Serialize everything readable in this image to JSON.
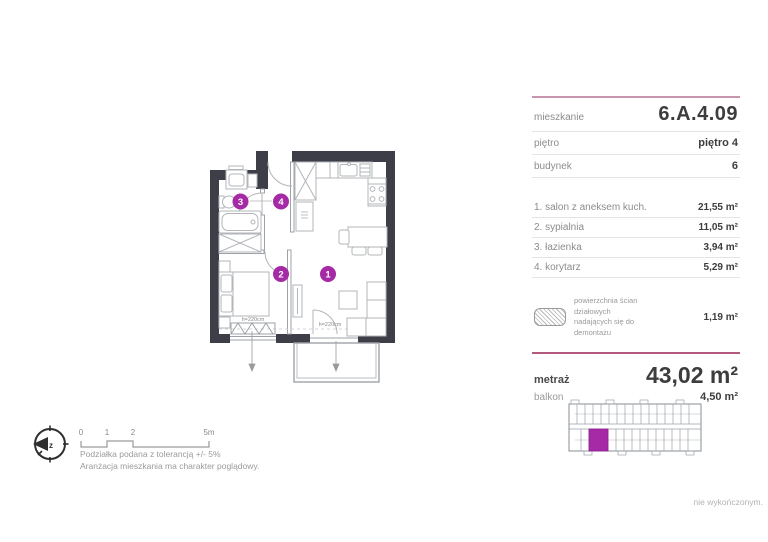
{
  "colors": {
    "accent": "#a62aa6",
    "wall": "#3e3e48",
    "panel_top_line": "#c795ae",
    "metraz_line": "#b4587e"
  },
  "panel": {
    "info_rows": [
      {
        "label": "mieszkanie",
        "value": "6.A.4.09"
      },
      {
        "label": "piętro",
        "value": "piętro 4"
      },
      {
        "label": "budynek",
        "value": "6"
      }
    ],
    "rooms": [
      {
        "label": "1. salon z aneksem kuch.",
        "value": "21,55 m²"
      },
      {
        "label": "2. sypialnia",
        "value": "11,05 m²"
      },
      {
        "label": "3. łazienka",
        "value": "3,94 m²"
      },
      {
        "label": "4. korytarz",
        "value": "5,29 m²"
      }
    ],
    "demolition_note": {
      "line1": "powierzchnia ścian działowych",
      "line2": "nadających się do demontażu",
      "value": "1,19 m²"
    },
    "area": {
      "label": "metraż",
      "value": "43,02 m²"
    },
    "balcony": {
      "label": "balkon",
      "value": "4,50 m²"
    }
  },
  "plan": {
    "badges": {
      "b1": "1",
      "b2": "2",
      "b3": "3",
      "b4": "4"
    },
    "window_label_bedroom": "h=220cm",
    "window_label_balcony": "h=220cm"
  },
  "scalebar": {
    "t0": "0",
    "t1": "1",
    "t2": "2",
    "t3": "5m"
  },
  "compass": {
    "label": "z"
  },
  "footer": {
    "note1": "Podziałka podana z tolerancją +/- 5%",
    "note2": "Aranżacja mieszkania ma charakter poglądowy.",
    "bottom_right": "nie wykończonym."
  }
}
